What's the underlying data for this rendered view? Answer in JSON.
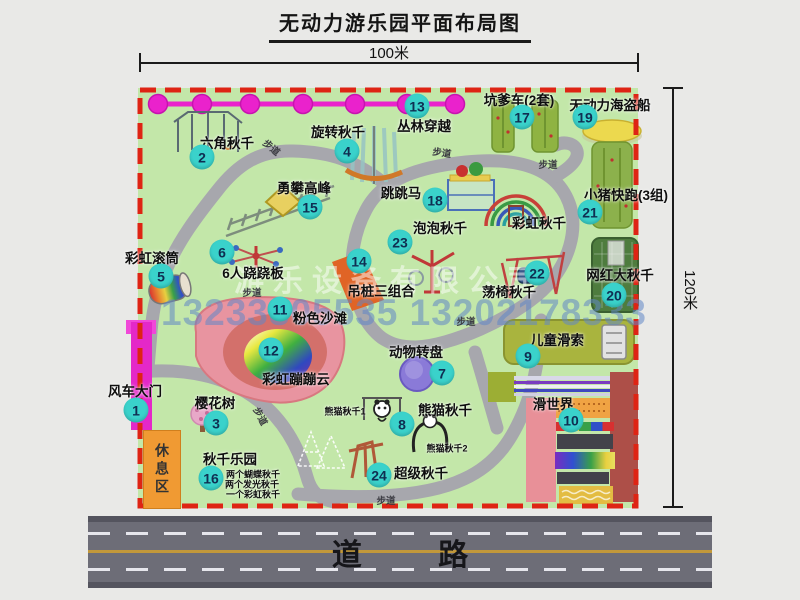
{
  "title": "无动力游乐园平面布局图",
  "dimensions": {
    "width_label": "100米",
    "height_label": "120米"
  },
  "road": {
    "label": "道 路"
  },
  "rest_area": {
    "label": "休息区"
  },
  "walkway_label": "步道",
  "watermark": {
    "company": "游乐设备有限公司",
    "phones": "13233805535 13202178333"
  },
  "colors": {
    "park_green": "#c3e7a9",
    "border_red": "#de2414",
    "badge_cyan": "#3ad2cb",
    "trail_magenta": "#ea22cc",
    "gate_magenta": "#e428c8",
    "rest_orange": "#f09a33",
    "road_gray": "#6d6d77"
  },
  "attractions": [
    {
      "num": "1",
      "label": "风车大门"
    },
    {
      "num": "2",
      "label": "六角秋千"
    },
    {
      "num": "3",
      "label": "樱花树"
    },
    {
      "num": "4",
      "label": "旋转秋千"
    },
    {
      "num": "5",
      "label": "彩虹滚筒"
    },
    {
      "num": "6",
      "label": "6人跷跷板"
    },
    {
      "num": "7",
      "label": "动物转盘"
    },
    {
      "num": "8",
      "label": "熊猫秋千",
      "sub1": "熊猫秋千1",
      "sub2": "熊猫秋千2"
    },
    {
      "num": "9",
      "label": "儿童滑索"
    },
    {
      "num": "10",
      "label": "滑世界"
    },
    {
      "num": "11",
      "label": "粉色沙滩"
    },
    {
      "num": "12",
      "label": "彩虹蹦蹦云"
    },
    {
      "num": "13",
      "label": "丛林穿越"
    },
    {
      "num": "14",
      "label": "吊桩三组合"
    },
    {
      "num": "15",
      "label": "勇攀高峰"
    },
    {
      "num": "16",
      "label": "秋千乐园",
      "notes": [
        "两个蝴蝶秋千",
        "两个发光秋千",
        "一个彩虹秋千"
      ]
    },
    {
      "num": "17",
      "label": "坑爹车(2套)"
    },
    {
      "num": "18",
      "label": "跳跳马"
    },
    {
      "num": "19",
      "label": "无动力海盗船"
    },
    {
      "num": "20",
      "label": "网红大秋千"
    },
    {
      "num": "21",
      "label": "小猪快跑(3组)"
    },
    {
      "num": "22",
      "label": "荡椅秋千"
    },
    {
      "num": "23",
      "label": "泡泡秋千"
    },
    {
      "num": "24",
      "label": "超级秋千"
    },
    {
      "label": "彩虹秋千"
    }
  ]
}
